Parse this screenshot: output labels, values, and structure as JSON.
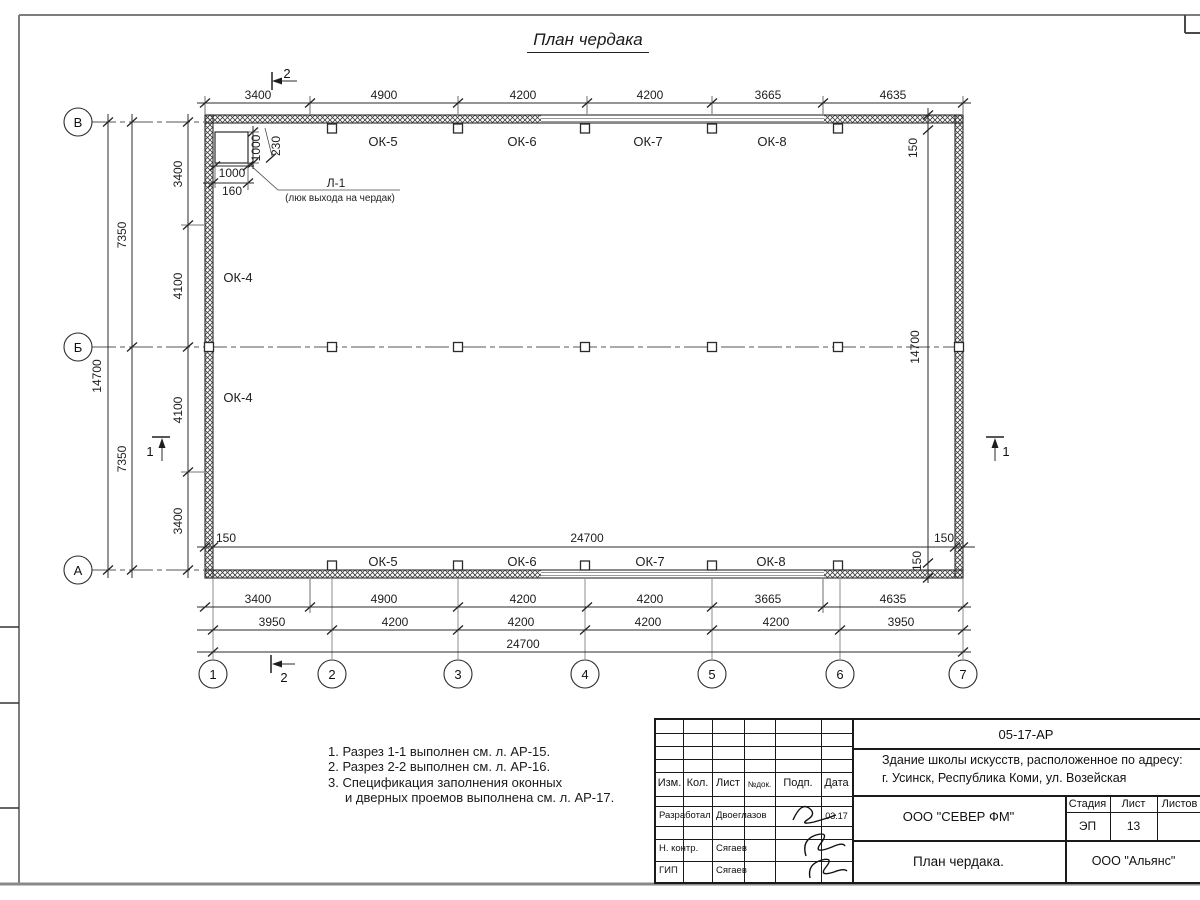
{
  "page_title": "План чердака",
  "plan": {
    "axes_h": [
      "1",
      "2",
      "3",
      "4",
      "5",
      "6",
      "7"
    ],
    "axes_v": [
      "В",
      "Б",
      "А"
    ],
    "dim_top": [
      "3400",
      "4900",
      "4200",
      "4200",
      "3665",
      "4635"
    ],
    "dim_bottom_windows": [
      "3400",
      "4900",
      "4200",
      "4200",
      "3665",
      "4635"
    ],
    "dim_bottom_axes": [
      "3950",
      "4200",
      "4200",
      "4200",
      "4200",
      "3950"
    ],
    "dim_bottom_total": "24700",
    "dim_inner_width": "24700",
    "dim_left_inner": [
      "3400",
      "4100",
      "4100",
      "3400"
    ],
    "dim_left_spans": [
      "7350",
      "7350"
    ],
    "dim_left_total": "14700",
    "dim_right_height": "14700",
    "dim_offset": "150",
    "windows_top": [
      "ОК-5",
      "ОК-6",
      "ОК-7",
      "ОК-8"
    ],
    "windows_bottom": [
      "ОК-5",
      "ОК-6",
      "ОК-7",
      "ОК-8"
    ],
    "windows_left": [
      "ОК-4",
      "ОК-4"
    ],
    "section_1": "1",
    "section_2": "2",
    "hatch_door": {
      "label": "Л-1",
      "caption": "(люк выхода на чердак)",
      "dim_width": "1000",
      "dim_height": "1000",
      "dim_offset_a": "230",
      "dim_offset_b": "160"
    }
  },
  "notes": {
    "line1": "1. Разрез 1-1 выполнен см. л. АР-15.",
    "line2": "2. Разрез 2-2 выполнен см. л. АР-16.",
    "line3": "3. Спецификация заполнения оконных",
    "line4": "и дверных проемов выполнена см. л. АР-17."
  },
  "titleblock": {
    "doc_number": "05-17-АР",
    "project_line1": "Здание школы искусств, расположенное по адресу:",
    "project_line2": "г. Усинск, Республика Коми, ул. Возейская",
    "org": "ООО \"СЕВЕР ФМ\"",
    "sheet_title": "План чердака.",
    "contractor": "ООО \"Альянс\"",
    "stage_label": "Стадия",
    "sheet_label": "Лист",
    "sheets_label": "Листов",
    "stage_value": "ЭП",
    "sheet_value": "13",
    "col_izm": "Изм.",
    "col_kol": "Кол.",
    "col_list": "Лист",
    "col_doc": "№док.",
    "col_podp": "Подп.",
    "col_data": "Дата",
    "row1_role": "Разработал",
    "row1_name": "Двоеглазов",
    "row1_date": "03.17",
    "row2_role": "Н. контр.",
    "row2_name": "Сягаев",
    "row3_role": "ГИП",
    "row3_name": "Сягаев"
  }
}
